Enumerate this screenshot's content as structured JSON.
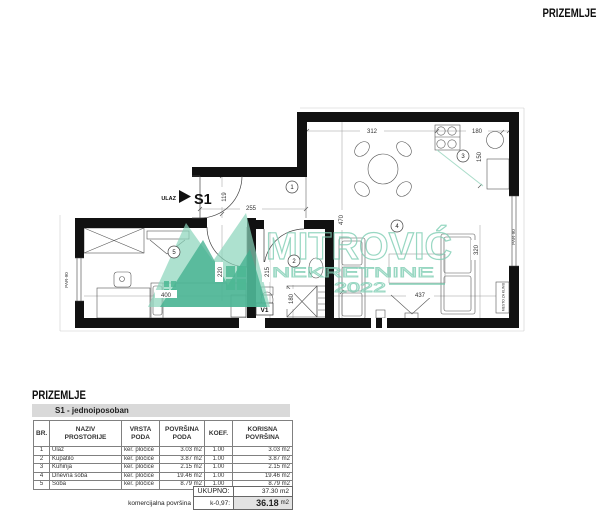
{
  "header": {
    "floor_label": "PRIZEMLJE"
  },
  "plan": {
    "entrance": {
      "label": "ULAZ",
      "unit_code": "S1"
    },
    "room_numbers": [
      "1",
      "2",
      "3",
      "4",
      "5"
    ],
    "dims": {
      "d312": "312",
      "d180_top": "180",
      "d150": "150",
      "d255": "255",
      "d119": "119",
      "d470": "470",
      "d220": "220",
      "d400": "400",
      "d215": "215",
      "d180_bath": "180",
      "d320": "320",
      "d437": "437"
    },
    "labels": {
      "par90_left": "PAR-90",
      "par90_right": "PAR-90",
      "v1": "V1",
      "klima": "MESTO ZA KLIMU"
    },
    "watermark": {
      "name": "MITROVIĆ",
      "line2": "NEKRETNINE",
      "line3": "2022"
    }
  },
  "table": {
    "section_title": "PRIZEMLJE",
    "subtitle": "S1 - jednoiposoban",
    "headers": {
      "br": "BR.",
      "naziv": "NAZIV\nPROSTORIJE",
      "vrsta": "VRSTA\nPODA",
      "povrsina": "POVRŠINA\nPODA",
      "koef": "KOEF.",
      "korisna": "KORISNA\nPOVRŠINA"
    },
    "rows": [
      {
        "br": "1",
        "naziv": "Ulaz",
        "vrsta": "ker. pločice",
        "povrsina": "3.03 m2",
        "koef": "1.00",
        "korisna": "3.03 m2"
      },
      {
        "br": "2",
        "naziv": "Kupatilo",
        "vrsta": "ker. pločice",
        "povrsina": "3.87 m2",
        "koef": "1.00",
        "korisna": "3.87 m2"
      },
      {
        "br": "3",
        "naziv": "Kuhinja",
        "vrsta": "ker. pločice",
        "povrsina": "2.15 m2",
        "koef": "1.00",
        "korisna": "2.15 m2"
      },
      {
        "br": "4",
        "naziv": "Dnevna soba",
        "vrsta": "ker. pločice",
        "povrsina": "19.46 m2",
        "koef": "1.00",
        "korisna": "19.46 m2"
      },
      {
        "br": "5",
        "naziv": "Soba",
        "vrsta": "ker. pločice",
        "povrsina": "8.79 m2",
        "koef": "1.00",
        "korisna": "8.79 m2"
      }
    ],
    "totals": {
      "ukupno_label": "UKUPNO:",
      "ukupno_value": "37.30 m2",
      "commercial_label": "komercijalna površina",
      "koef_label": "k-0,97:",
      "value": "36.18",
      "unit": "m2"
    }
  },
  "colors": {
    "wall": "#111111",
    "watermark_green": "#7fceb4",
    "watermark_light": "#8ad4ba",
    "watermark_dark": "#3fae8c",
    "accent_line": "#a9dcc9",
    "subtitle_bar": "#d9d9d9",
    "total_highlight": "#e3e3e3"
  }
}
